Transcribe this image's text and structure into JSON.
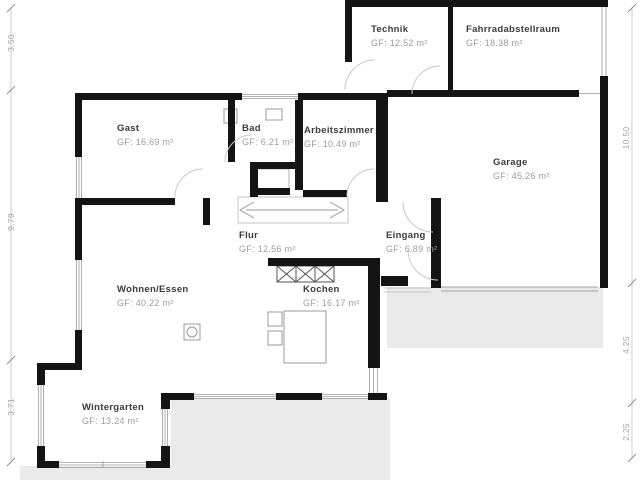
{
  "title": "Bungalow Grundriss / floor plan",
  "rooms": [
    {
      "name": "Technik",
      "area": "GF: 12.52 m²"
    },
    {
      "name": "Fahrradabstellraum",
      "area": "GF: 18.38 m²"
    },
    {
      "name": "Gast",
      "area": "GF: 16.69 m²"
    },
    {
      "name": "Bad",
      "area": "GF: 6.21 m²"
    },
    {
      "name": "Arbeitszimmer",
      "area": "GF: 10.49 m²"
    },
    {
      "name": "Garage",
      "area": "GF: 45.26 m²"
    },
    {
      "name": "Flur",
      "area": "GF: 12.56 m²"
    },
    {
      "name": "Eingang",
      "area": "GF: 6.89 m²"
    },
    {
      "name": "Wohnen/Essen",
      "area": "GF: 40.22 m²"
    },
    {
      "name": "Kochen",
      "area": "GF: 16.17 m²"
    },
    {
      "name": "Wintergarten",
      "area": "GF: 13.24 m²"
    }
  ],
  "dimensions": {
    "left": [
      "3.50",
      "9.79",
      "3.71"
    ],
    "right": [
      "10.50",
      "4.25",
      "2.25"
    ]
  },
  "colors": {
    "wall": "#141414",
    "terrace": "#eaeaea",
    "window_line": "#9a9a9a",
    "door_arc": "#c9c9c9",
    "dim_text": "#a3a3a3",
    "room_name": "#3a3a3a",
    "room_area": "#9c9c9c"
  }
}
